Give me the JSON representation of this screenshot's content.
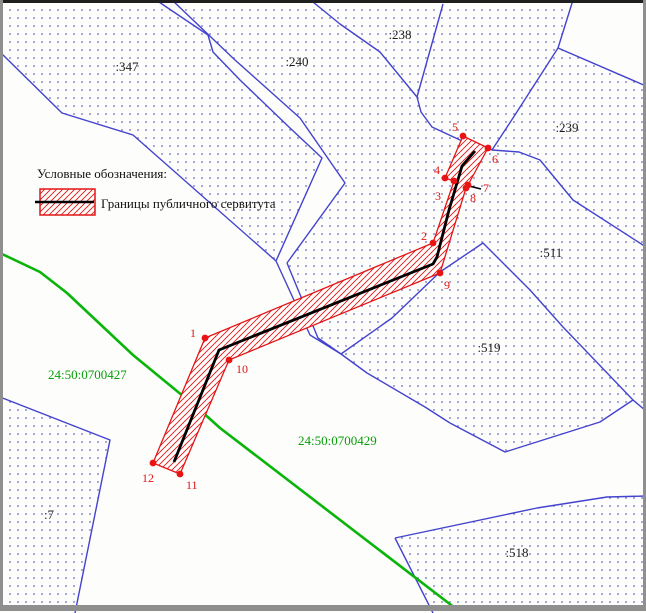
{
  "map": {
    "title_hint": "cadastral plan with public servitude corridor",
    "legend": {
      "title": "Условные обозначения:",
      "item_label": "Границы публичного сервитута"
    },
    "parcel_labels": {
      "p347": ":347",
      "p240": ":240",
      "p238": ":238",
      "p239": ":239",
      "p511": ":511",
      "p519": ":519",
      "p518": ":518",
      "p7": ":7"
    },
    "zone_labels": {
      "z427": "24:50:0700427",
      "z429": "24:50:0700429"
    },
    "points": {
      "p1": "1",
      "p2": "2",
      "p3": "3",
      "p4": "4",
      "p5": "5",
      "p6": "6",
      "p7": "7",
      "p8": "8",
      "p9": "9",
      "p10": "10",
      "p11": "11",
      "p12": "12"
    },
    "colors": {
      "parcel_boundary_blue": "#4343cf",
      "dot_fill_blue": "#6a6abf",
      "servitude_red": "#e31616",
      "point_red": "#e81414",
      "centerline_black": "#000000",
      "cadastral_green": "#0ab40a",
      "zone_text_green": "#089e08",
      "label_black": "#1c1c1c",
      "frame_gray": "#8f8f8f"
    }
  }
}
